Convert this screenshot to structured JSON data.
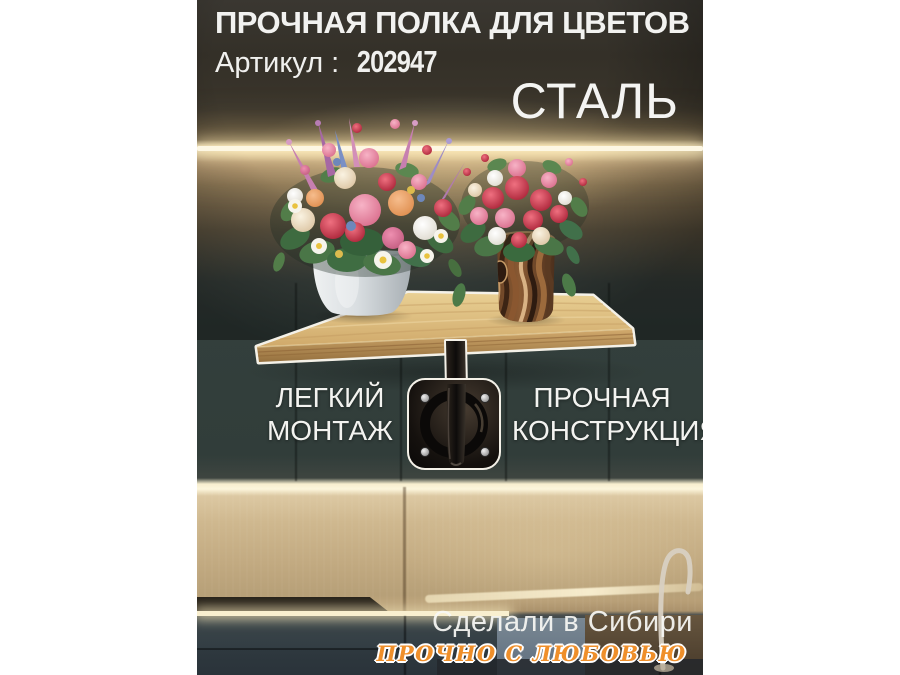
{
  "poster": {
    "header": {
      "title": "ПРОЧНАЯ ПОЛКА ДЛЯ ЦВЕТОВ",
      "article_label": "Артикул :",
      "article_number": "202947",
      "material": "СТАЛЬ"
    },
    "features": {
      "left": {
        "line1": "ЛЕГКИЙ",
        "line2": "МОНТАЖ"
      },
      "right": {
        "line1": "ПРОЧНАЯ",
        "line2": "КОНСТРУКЦИЯ"
      }
    },
    "footer": {
      "origin": "Сделали в Сибири",
      "slogan": "ПРОЧНО С ЛЮБОВЬЮ"
    },
    "palette": {
      "slogan_orange": "#ef8f2a",
      "text_white": "#f2f2f0",
      "shelf_wood": "#d3ab6e",
      "led_warm": "#fdf4da",
      "cabinet_teal": "#33403d",
      "bracket_black": "#151210"
    }
  }
}
